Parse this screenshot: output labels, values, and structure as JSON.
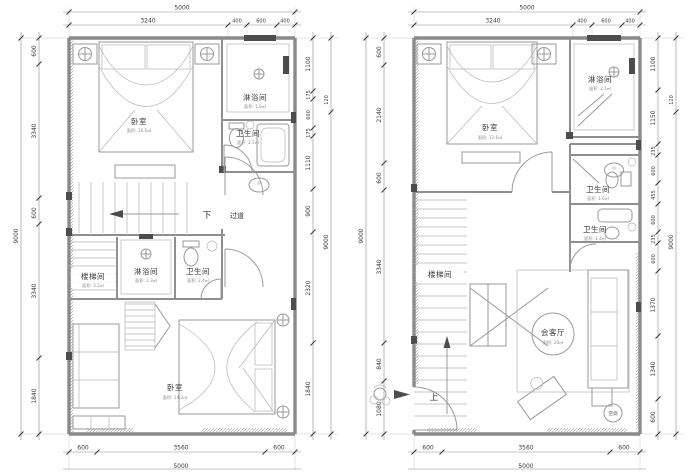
{
  "drawing": {
    "plans": [
      {
        "title": "left-plan",
        "dims": {
          "top_total": "5000",
          "top": [
            "3240",
            "400",
            "600",
            "400"
          ],
          "left_total": "9000",
          "left": [
            "600",
            "3340",
            "600",
            "3340",
            "1840"
          ],
          "right_total": "9000",
          "right_upper": "120",
          "right": [
            "1100",
            "175",
            "600",
            "175",
            "1110",
            "900",
            "2320",
            "1840"
          ],
          "bottom": [
            "600",
            "3560",
            "600"
          ],
          "bottom_total": "5000"
        },
        "rooms": [
          {
            "label": "卧室",
            "area": "面积: 16.5㎡"
          },
          {
            "label": "淋浴间",
            "area": "面积: 1.8㎡"
          },
          {
            "label": "卫生间",
            "area": "面积: 2.1㎡"
          },
          {
            "label": "楼梯间",
            "area": "面积: 3.2㎡"
          },
          {
            "label": "淋浴间",
            "area": "面积: 2.3㎡"
          },
          {
            "label": "卫生间",
            "area": "面积: 2.4㎡"
          },
          {
            "label": "卧室",
            "area": "面积: 14.2㎡"
          }
        ],
        "notes": {
          "down": "下",
          "corridor": "过道"
        }
      },
      {
        "title": "right-plan",
        "dims": {
          "top_total": "5000",
          "top": [
            "3240",
            "400",
            "600",
            "400"
          ],
          "left_total": "9000",
          "left": [
            "600",
            "2140",
            "600",
            "3340",
            "840",
            "1080"
          ],
          "right_total": "9000",
          "right_upper": "120",
          "right": [
            "1100",
            "1150",
            "235",
            "600",
            "455",
            "600",
            "235",
            "600",
            "1370",
            "1340",
            "600"
          ],
          "bottom": [
            "600",
            "3560",
            "600"
          ],
          "bottom_total": "5000"
        },
        "rooms": [
          {
            "label": "卧室",
            "area": "面积: 12.6㎡"
          },
          {
            "label": "淋浴间",
            "area": "面积: 2.1㎡"
          },
          {
            "label": "卫生间",
            "area": "面积: 1.6㎡"
          },
          {
            "label": "卫生间",
            "area": "面积: 1.4㎡"
          },
          {
            "label": "楼梯间",
            "area": ""
          },
          {
            "label": "会客厅",
            "area": "面积: 20㎡"
          }
        ],
        "notes": {
          "up": "上",
          "ac": "空调"
        }
      }
    ]
  }
}
